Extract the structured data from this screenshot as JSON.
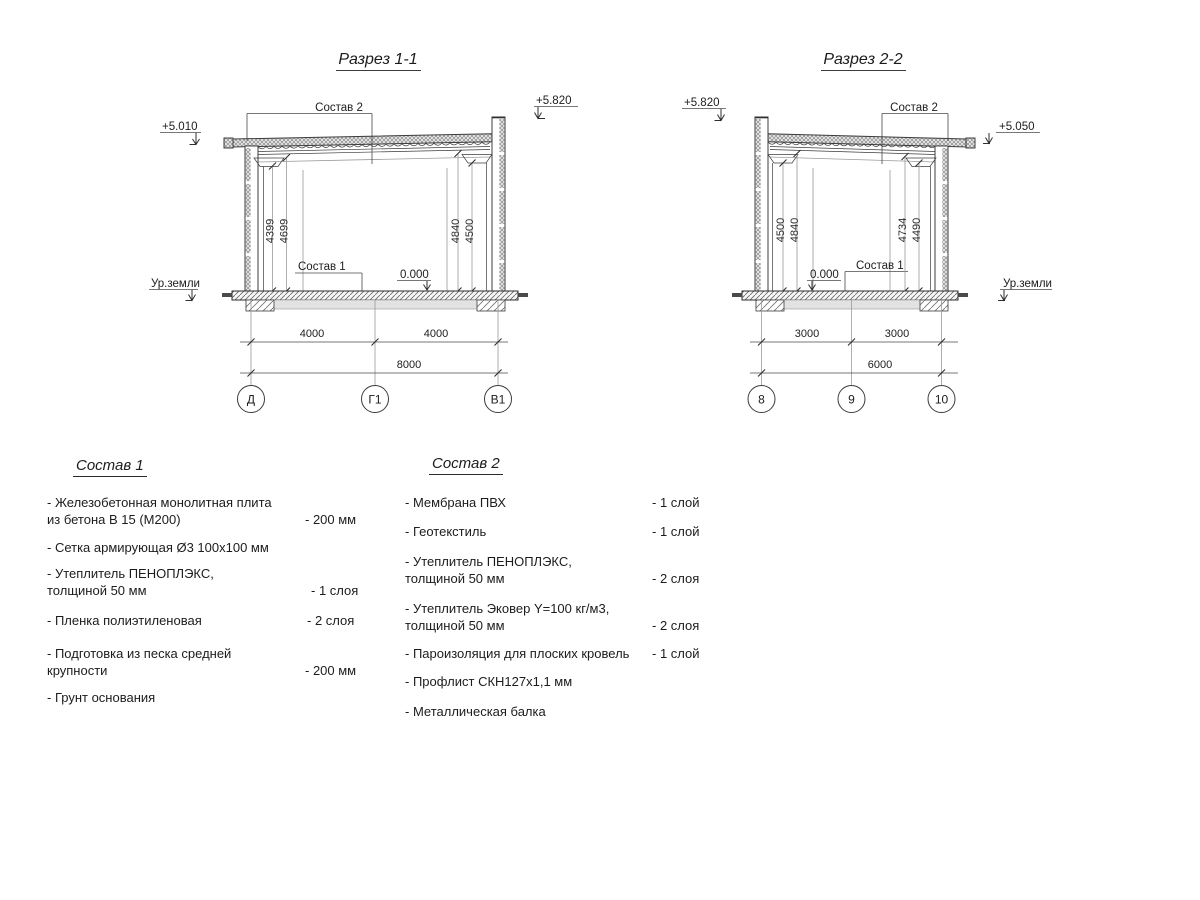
{
  "drawing": {
    "section1": {
      "title": "Разрез 1-1",
      "elev_eave": "+5.010",
      "elev_parapet": "+5.820",
      "callout_roof": "Состав 2",
      "callout_floor": "Состав 1",
      "level_zero": "0.000",
      "ground_label": "Ур.земли",
      "vdims": [
        "4399",
        "4699",
        "4840",
        "4500"
      ],
      "hdims": [
        "4000",
        "4000"
      ],
      "hdim_total": "8000",
      "axes": [
        "Д",
        "Г1",
        "В1"
      ]
    },
    "section2": {
      "title": "Разрез 2-2",
      "elev_parapet": "+5.820",
      "elev_eave": "+5.050",
      "callout_roof": "Состав 2",
      "callout_floor": "Состав 1",
      "level_zero": "0.000",
      "ground_label": "Ур.земли",
      "vdims": [
        "4500",
        "4840",
        "4734",
        "4490"
      ],
      "hdims": [
        "3000",
        "3000"
      ],
      "hdim_total": "6000",
      "axes": [
        "8",
        "9",
        "10"
      ]
    }
  },
  "legend1": {
    "title": "Состав 1",
    "items": [
      {
        "text": "- Железобетонная  монолитная плита\nиз бетона В 15 (М200)",
        "qty": "- 200 мм"
      },
      {
        "text": "- Сетка армирующая Ø3 100х100 мм",
        "qty": ""
      },
      {
        "text": "-  Утеплитель ПЕНОПЛЭКС,\n  толщиной 50 мм",
        "qty": "- 1 слоя"
      },
      {
        "text": "- Пленка полиэтиленовая",
        "qty": "-  2 слоя"
      },
      {
        "text": "- Подготовка из песка средней\n  крупности",
        "qty": "- 200 мм"
      },
      {
        "text": "- Грунт основания",
        "qty": ""
      }
    ]
  },
  "legend2": {
    "title": "Состав 2",
    "items": [
      {
        "text": "- Мембрана ПВХ",
        "qty": "- 1 слой"
      },
      {
        "text": "- Геотекстиль",
        "qty": "- 1 слой"
      },
      {
        "text": "- Утеплитель ПЕНОПЛЭКС,\n  толщиной 50 мм",
        "qty": "- 2 слоя"
      },
      {
        "text": "- Утеплитель Эковер Y=100 кг/м3,\n  толщиной 50 мм",
        "qty": "- 2 слоя"
      },
      {
        "text": "- Пароизоляция для плоских кровель",
        "qty": "- 1 слой"
      },
      {
        "text": "- Профлист СКН127х1,1 мм",
        "qty": ""
      },
      {
        "text": "- Металлическая балка",
        "qty": ""
      }
    ]
  }
}
